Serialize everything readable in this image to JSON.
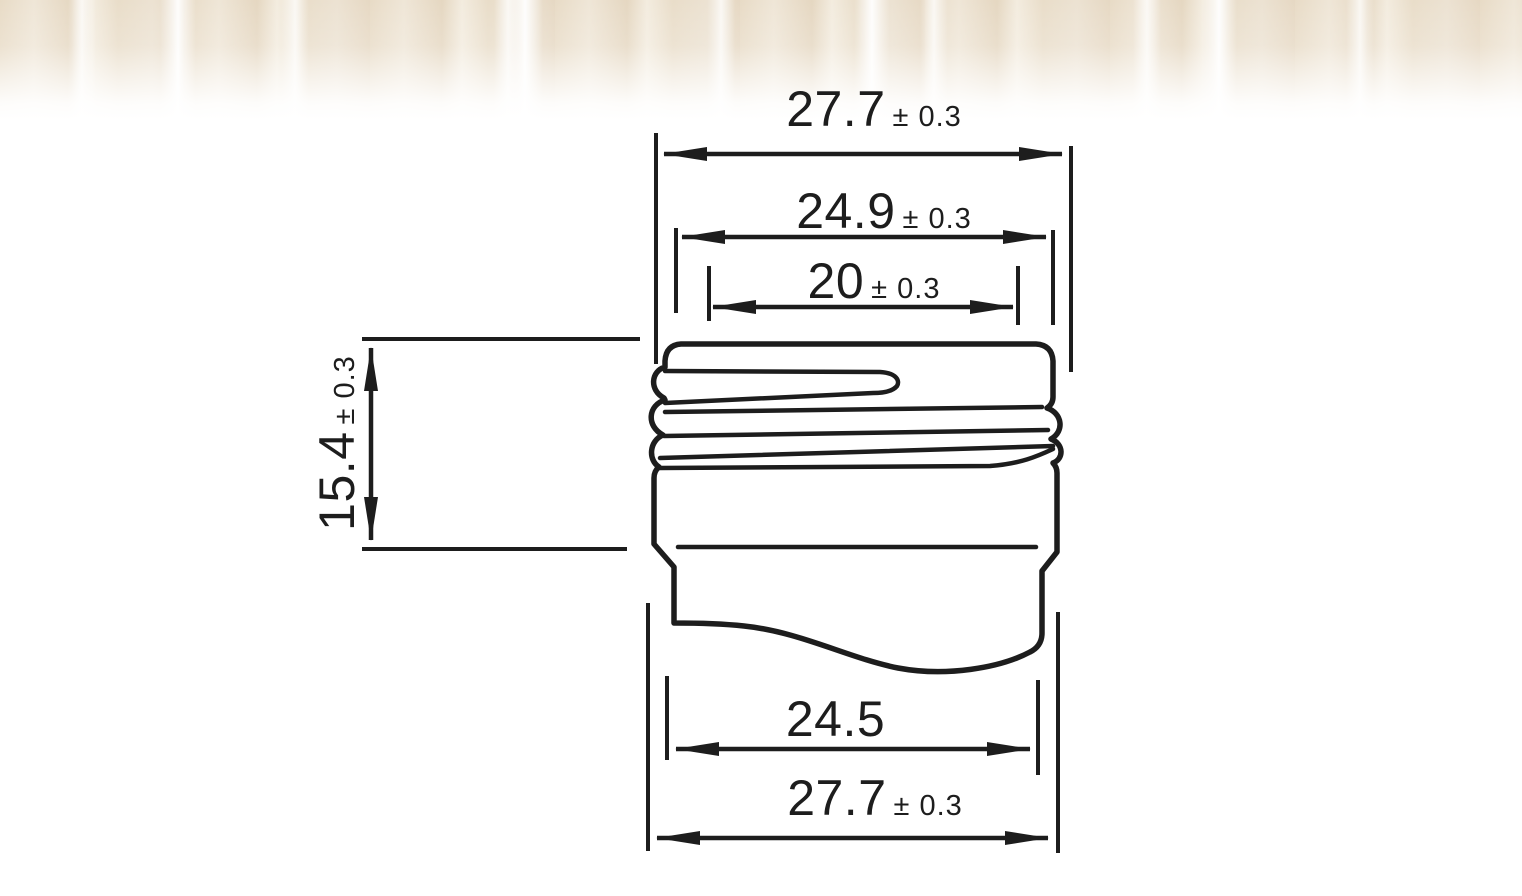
{
  "page": {
    "background": "#ffffff",
    "line_color": "#1d1d1d",
    "photo_strip_colors": [
      "#e8dbc6",
      "#efe6d7",
      "#e5d7c1",
      "#ffffff"
    ]
  },
  "drawing": {
    "kind": "screw-cap neck finish profile, dimensioned",
    "dimensions": {
      "top_width": {
        "value": "27.7",
        "tolerance": "± 0.3"
      },
      "thread_outer_diameter": {
        "value": "24.9",
        "tolerance": "± 0.3"
      },
      "thread_inner_diameter": {
        "value": "20",
        "tolerance": "± 0.3"
      },
      "neck_height": {
        "value": "15.4",
        "tolerance": "± 0.3"
      },
      "shoulder_diameter": {
        "value": "24.5",
        "tolerance": ""
      },
      "bottom_width": {
        "value": "27.7",
        "tolerance": "± 0.3"
      }
    }
  }
}
